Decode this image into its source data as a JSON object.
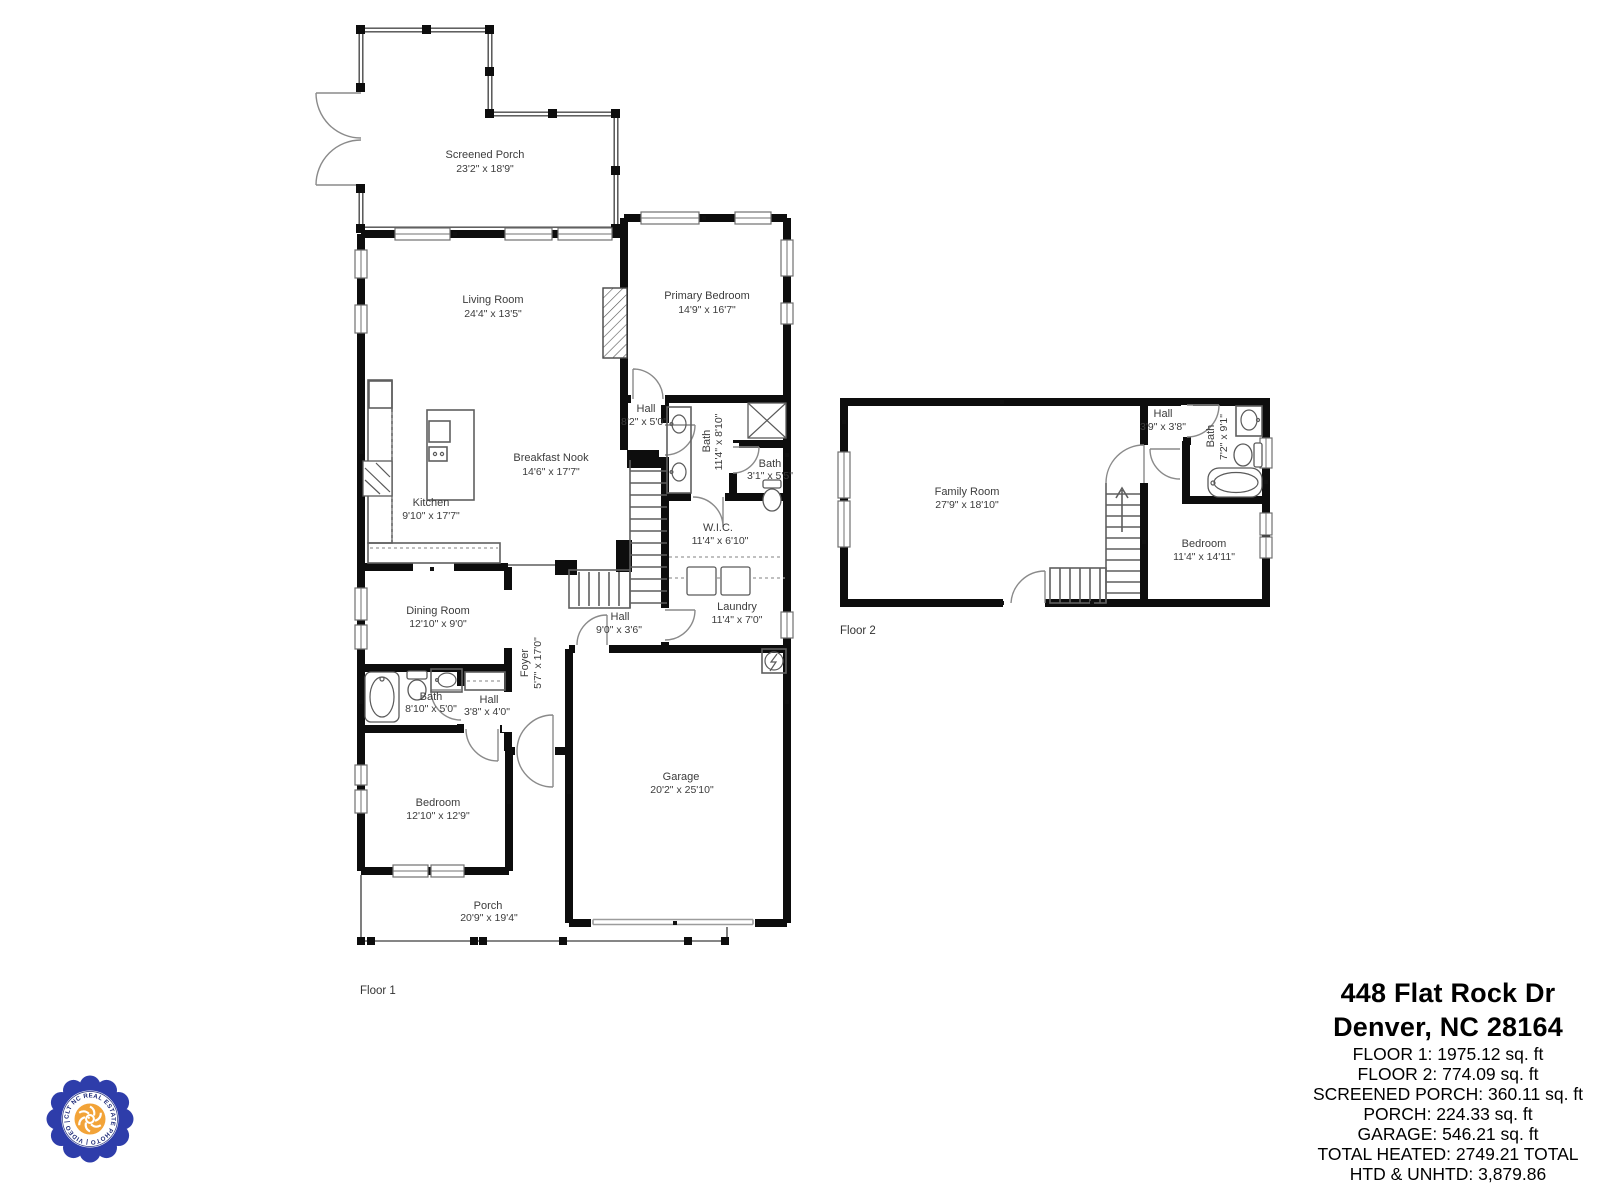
{
  "floor1": {
    "label": "Floor 1",
    "rooms": {
      "screened_porch": {
        "name": "Screened Porch",
        "dims": "23'2\" x 18'9\""
      },
      "living_room": {
        "name": "Living Room",
        "dims": "24'4\" x 13'5\""
      },
      "primary_bedroom": {
        "name": "Primary Bedroom",
        "dims": "14'9\" x 16'7\""
      },
      "kitchen": {
        "name": "Kitchen",
        "dims": "9'10\" x 17'7\""
      },
      "breakfast_nook": {
        "name": "Breakfast Nook",
        "dims": "14'6\" x 17'7\""
      },
      "hall_upper": {
        "name": "Hall",
        "dims": "8'2\" x 5'0\""
      },
      "bath_primary": {
        "name": "Bath",
        "dims": "11'4\" x 8'10\""
      },
      "bath_small": {
        "name": "Bath",
        "dims": "3'1\" x 5'5\""
      },
      "wic": {
        "name": "W.I.C.",
        "dims": "11'4\" x 6'10\""
      },
      "dining_room": {
        "name": "Dining Room",
        "dims": "12'10\" x 9'0\""
      },
      "laundry": {
        "name": "Laundry",
        "dims": "11'4\" x 7'0\""
      },
      "hall_mid": {
        "name": "Hall",
        "dims": "9'0\" x 3'6\""
      },
      "foyer": {
        "name": "Foyer",
        "dims": "5'7\" x 17'0\""
      },
      "bath_lower": {
        "name": "Bath",
        "dims": "8'10\" x 5'0\""
      },
      "hall_lower": {
        "name": "Hall",
        "dims": "3'8\" x 4'0\""
      },
      "bedroom": {
        "name": "Bedroom",
        "dims": "12'10\" x 12'9\""
      },
      "garage": {
        "name": "Garage",
        "dims": "20'2\" x 25'10\""
      },
      "porch": {
        "name": "Porch",
        "dims": "20'9\" x 19'4\""
      }
    }
  },
  "floor2": {
    "label": "Floor 2",
    "rooms": {
      "family_room": {
        "name": "Family Room",
        "dims": "27'9\" x 18'10\""
      },
      "hall": {
        "name": "Hall",
        "dims": "3'9\" x 3'8\""
      },
      "bath": {
        "name": "Bath",
        "dims": "7'2\" x 9'1\""
      },
      "bedroom": {
        "name": "Bedroom",
        "dims": "11'4\" x 14'11\""
      }
    }
  },
  "info": {
    "address_line1": "448 Flat Rock Dr",
    "address_line2": "Denver, NC 28164",
    "stats": [
      "FLOOR 1: 1975.12 sq. ft",
      "FLOOR 2: 774.09 sq. ft",
      "SCREENED PORCH: 360.11 sq. ft",
      "PORCH: 224.33 sq. ft",
      "GARAGE: 546.21 sq. ft",
      "TOTAL HEATED: 2749.21 TOTAL",
      "HTD & UNHTD: 3,879.86"
    ]
  },
  "logo": {
    "ring_text": "CLT NC REAL ESTATE PHOTO | VIDEO |"
  },
  "colors": {
    "wall": "#0d0d0d",
    "logo_blue": "#2e3daa",
    "logo_orange": "#f2a338",
    "logo_navy": "#1e2a78"
  }
}
